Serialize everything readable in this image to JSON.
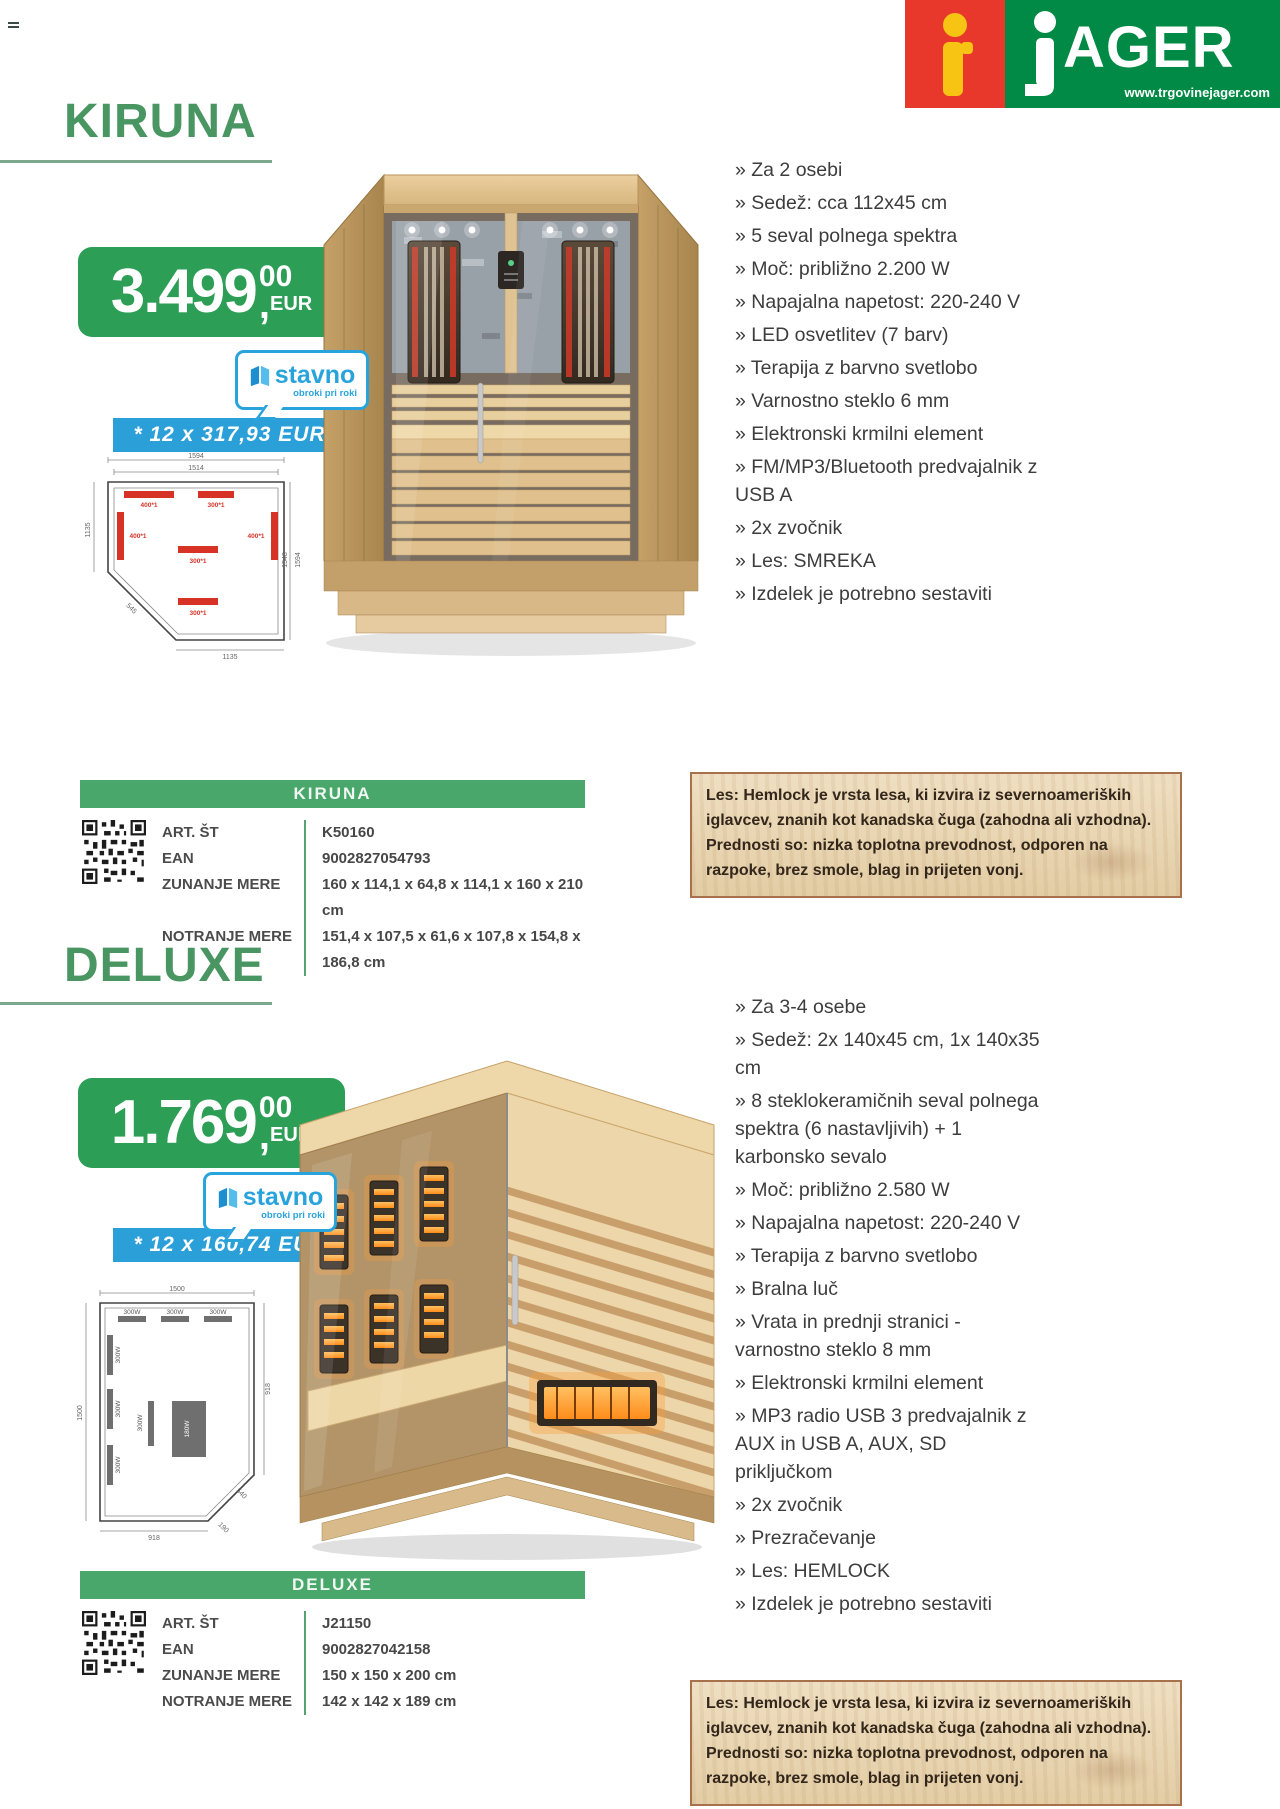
{
  "header": {
    "menu_icon": "hamburger-lines",
    "logo": {
      "brand_suffix": "AGER",
      "website": "www.trgovinejager.com",
      "colors": {
        "red": "#e8382c",
        "green": "#008a45",
        "yellow": "#f7c414"
      }
    }
  },
  "stavno_badge": {
    "name": "stavno",
    "tagline": "obroki pri roki",
    "color": "#29a3dc"
  },
  "wood_info": {
    "text": "Les: Hemlock je vrsta lesa, ki izvira iz severnoameriških iglavcev, znanih kot kanadska čuga (zahodna ali vzhodna). Prednosti so: nizka toplotna prevodnost, odporen na razpoke, brez smole, blag in prijeten vonj."
  },
  "colors": {
    "heading_green": "#4a9663",
    "price_green": "#2d9e56",
    "bar_green": "#4aa76b",
    "blue": "#2b9fd7",
    "text": "#3d3d3d"
  },
  "products": [
    {
      "name": "KIRUNA",
      "price": {
        "main": "3.499",
        "cents": "00",
        "comma": ",",
        "currency": "EUR"
      },
      "installment": "* 12 x 317,93 EUR",
      "features": [
        "» Za 2 osebi",
        "» Sedež: cca 112x45 cm",
        "» 5 seval polnega spektra",
        "» Moč: približno 2.200 W",
        "» Napajalna napetost: 220-240 V",
        "» LED osvetlitev (7 barv)",
        "» Terapija z barvno svetlobo",
        "» Varnostno steklo 6 mm",
        "» Elektronski krmilni element",
        "» FM/MP3/Bluetooth predvajalnik z USB A",
        "» 2x zvočnik",
        "» Les: SMREKA",
        "» Izdelek je potrebno sestaviti"
      ],
      "table": {
        "title": "KIRUNA",
        "rows": [
          {
            "label": "ART. ŠT",
            "value": "K50160"
          },
          {
            "label": "EAN",
            "value": "9002827054793"
          },
          {
            "label": "ZUNANJE MERE",
            "value": "160 x 114,1 x 64,8 x 114,1 x 160 x 210 cm"
          },
          {
            "label": "NOTRANJE MERE",
            "value": "151,4 x 107,5 x 61,6 x 107,8 x 154,8 x 186,8 cm"
          }
        ]
      },
      "plan": {
        "dims": [
          "1594",
          "1514",
          "1135",
          "1548",
          "1594",
          "1135",
          "545"
        ],
        "heaters": [
          "400*1",
          "300*1",
          "400*1",
          "400*1",
          "300*1",
          "300*1"
        ]
      }
    },
    {
      "name": "DELUXE",
      "price": {
        "main": "1.769",
        "cents": "00",
        "comma": ",",
        "currency": "EUR"
      },
      "installment": "* 12 x 160,74 EUR",
      "features": [
        "» Za 3-4 osebe",
        "» Sedež: 2x 140x45 cm, 1x 140x35 cm",
        "» 8 steklokeramičnih seval polnega spektra (6 nastavljivih) + 1 karbonsko sevalo",
        "» Moč: približno 2.580 W",
        "» Napajalna napetost: 220-240 V",
        "» Terapija z barvno svetlobo",
        "» Bralna luč",
        "» Vrata in prednji stranici - varnostno steklo 8 mm",
        "» Elektronski krmilni element",
        "» MP3 radio USB 3 predvajalnik z AUX in USB A, AUX, SD priključkom",
        "» 2x zvočnik",
        "» Prezračevanje",
        "» Les: HEMLOCK",
        "» Izdelek je potrebno sestaviti"
      ],
      "table": {
        "title": "DELUXE",
        "rows": [
          {
            "label": "ART. ŠT",
            "value": "J21150"
          },
          {
            "label": "EAN",
            "value": "9002827042158"
          },
          {
            "label": "ZUNANJE MERE",
            "value": "150 x 150 x 200 cm"
          },
          {
            "label": "NOTRANJE MERE",
            "value": "142 x 142 x 189 cm"
          }
        ]
      },
      "plan": {
        "dims": [
          "1500",
          "1500",
          "918",
          "918",
          "540",
          "190"
        ],
        "heaters": [
          "300W",
          "300W",
          "300W",
          "300W",
          "300W",
          "300W",
          "180W",
          "300W"
        ]
      }
    }
  ]
}
